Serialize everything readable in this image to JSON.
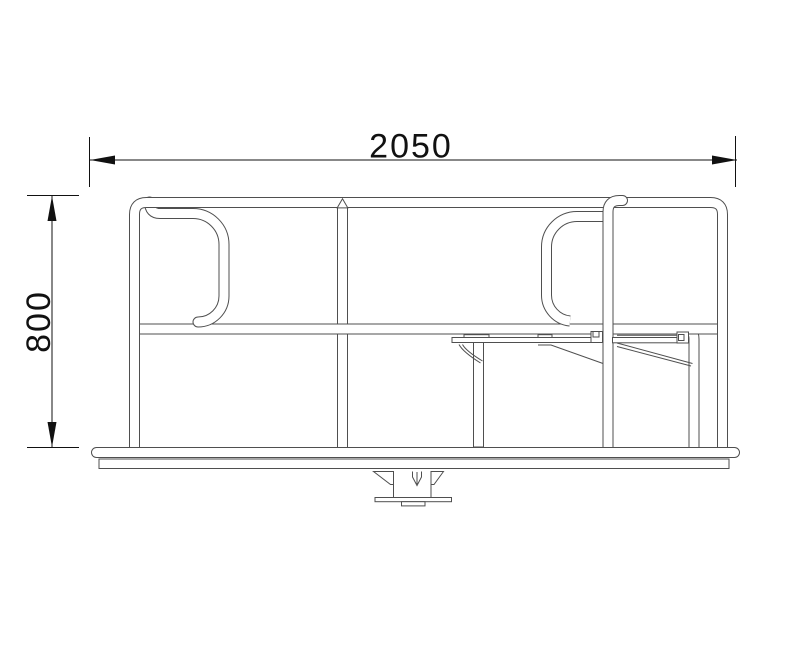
{
  "drawing": {
    "background_color": "#ffffff",
    "structure_line_color": "#4f4f4f",
    "dimension_line_color": "#111111",
    "dimensions": {
      "horizontal": {
        "label": "2050"
      },
      "vertical": {
        "label": "800"
      }
    }
  }
}
